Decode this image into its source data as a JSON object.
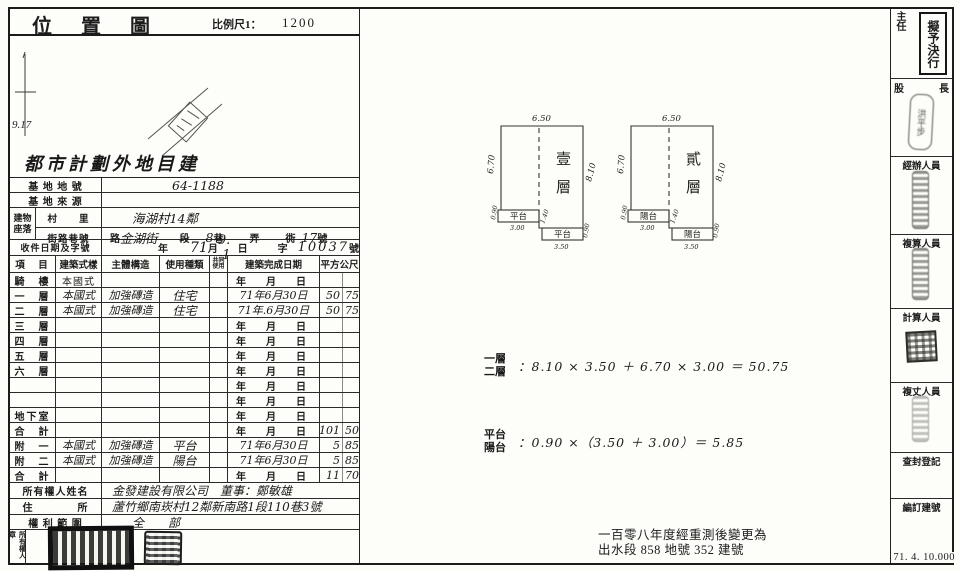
{
  "map": {
    "title": "位 置 圖",
    "scale_label": "比例尺1：",
    "scale_value": "1200",
    "north_value": "9.17",
    "overlay": "都市計劃外地目建"
  },
  "site": {
    "lot_label": "基 地 地 號",
    "lot_value": "64-1188",
    "source_label": "基 地 來 源",
    "source_value": "",
    "bldg_label_top": "建物",
    "bldg_label_bottom": "座落",
    "village_label": "村　　里",
    "village_value": "海湖村14鄰",
    "street_label": "街路巷號",
    "street": {
      "road": "路",
      "road_value": "金湖街",
      "sec": "段",
      "lane_value": "8",
      "lane": "巷",
      "nong": "弄",
      "xiang": "衖",
      "no_value": "17",
      "no": "號"
    },
    "receipt_label": "收件日期及字號",
    "receipt": {
      "year": "年",
      "year_value": "71",
      "month": "月",
      "day_value": "9. -1",
      "day": "日",
      "zi": "字",
      "no_value": "10037",
      "hao": "號"
    }
  },
  "floors": {
    "header": {
      "item": "項　目",
      "style": "建築式樣",
      "structure": "主體構造",
      "use": "使用種類",
      "tiny_top": "共同",
      "tiny_bottom": "使用",
      "date": "建築完成日期",
      "area": "平方公尺"
    },
    "rows": [
      {
        "name": "騎　樓",
        "style": "本國式",
        "style_class": "printedv",
        "structure": "",
        "use": "",
        "date": "年　月　日",
        "date_class": "pdate",
        "area_int": "",
        "area_dec": ""
      },
      {
        "name": "一　層",
        "style": "本國式",
        "style_class": "hand",
        "structure": "加強磚造",
        "use": "住宅",
        "date": "71年6月30日",
        "date_class": "hand",
        "area_int": "50",
        "area_dec": "75"
      },
      {
        "name": "二　層",
        "style": "本國式",
        "style_class": "hand",
        "structure": "加強磚造",
        "use": "住宅",
        "date": "71年.6月30日",
        "date_class": "hand",
        "area_int": "50",
        "area_dec": "75"
      },
      {
        "name": "三　層",
        "style": "",
        "style_class": "",
        "structure": "",
        "use": "",
        "date": "年　月　日",
        "date_class": "pdate",
        "area_int": "",
        "area_dec": ""
      },
      {
        "name": "四　層",
        "style": "",
        "style_class": "",
        "structure": "",
        "use": "",
        "date": "年　月　日",
        "date_class": "pdate",
        "area_int": "",
        "area_dec": ""
      },
      {
        "name": "五　層",
        "style": "",
        "style_class": "",
        "structure": "",
        "use": "",
        "date": "年　月　日",
        "date_class": "pdate",
        "area_int": "",
        "area_dec": ""
      },
      {
        "name": "六　層",
        "style": "",
        "style_class": "",
        "structure": "",
        "use": "",
        "date": "年　月　日",
        "date_class": "pdate",
        "area_int": "",
        "area_dec": ""
      },
      {
        "name": "",
        "style": "",
        "style_class": "",
        "structure": "",
        "use": "",
        "date": "年　月　日",
        "date_class": "pdate",
        "area_int": "",
        "area_dec": ""
      },
      {
        "name": "",
        "style": "",
        "style_class": "",
        "structure": "",
        "use": "",
        "date": "年　月　日",
        "date_class": "pdate",
        "area_int": "",
        "area_dec": ""
      },
      {
        "name": "地下室",
        "style": "",
        "style_class": "",
        "structure": "",
        "use": "",
        "date": "年　月　日",
        "date_class": "pdate",
        "area_int": "",
        "area_dec": ""
      },
      {
        "name": "合　計",
        "style": "",
        "style_class": "",
        "structure": "",
        "use": "",
        "date": "年　月　日",
        "date_class": "pdate",
        "area_int": "101",
        "area_dec": "50"
      },
      {
        "name": "附　一",
        "style": "本國式",
        "style_class": "hand",
        "structure": "加強磚造",
        "use": "平台",
        "date": "71年6月30日",
        "date_class": "hand",
        "area_int": "5",
        "area_dec": "85"
      },
      {
        "name": "附　二",
        "style": "本國式",
        "style_class": "hand",
        "structure": "加強磚造",
        "use": "陽台",
        "date": "71年6月30日",
        "date_class": "hand",
        "area_int": "5",
        "area_dec": "85"
      },
      {
        "name": "合　計",
        "style": "",
        "style_class": "",
        "structure": "",
        "use": "",
        "date": "年　月　日",
        "date_class": "pdate",
        "area_int": "11",
        "area_dec": "70"
      }
    ]
  },
  "owner": {
    "name_label": "所有權人姓名",
    "name_value": "金發建設有限公司　董事：鄭敏雄",
    "addr_label": "住　　　　所",
    "addr_value": "蘆竹鄉南崁村12鄰新南路1段110巷3號",
    "scope_label": "權 利 範 圍",
    "scope_value": "全　　部",
    "seal_label": "所有權人章"
  },
  "plans": {
    "p1": {
      "title_1": "壹",
      "title_2": "層",
      "top": "6.50",
      "left": "6.70",
      "right": "8.10",
      "annex1": "平台",
      "annex1_w": "3.00",
      "annex1_d": "0.90",
      "step": "1.40",
      "annex2": "平台",
      "annex2_w": "3.50",
      "annex2_d": "0.90"
    },
    "p2": {
      "title_1": "貳",
      "title_2": "層",
      "top": "6.50",
      "left": "6.70",
      "right": "8.10",
      "annex1": "陽台",
      "annex1_w": "3.00",
      "annex1_d": "0.90",
      "step": "1.40",
      "annex2": "陽台",
      "annex2_w": "3.50",
      "annex2_d": "0.90"
    }
  },
  "calc": {
    "c1_l1": "一層",
    "c1_l2": "二層",
    "c1_expr": "：8.10 × 3.50 ＋ 6.70 × 3.00 ＝ 50.75",
    "c2_l1": "平台",
    "c2_l2": "陽台",
    "c2_expr": "：0.90 ×（3.50 ＋ 3.00）＝ 5.85"
  },
  "strip": {
    "cells": [
      {
        "label": "主任"
      },
      {
        "label": "股長"
      },
      {
        "label": "經辦人員"
      },
      {
        "label": "複算人員"
      },
      {
        "label": "計算人員"
      },
      {
        "label": "複丈人員"
      },
      {
        "label": "查封登記"
      },
      {
        "label": "編訂建號"
      }
    ],
    "cell2_left": "股",
    "cell2_right": "長",
    "approval_stamp": "擬予決行",
    "chief_seal_name": "洪平步",
    "form_code": "71. 4. 10.000"
  },
  "note": {
    "line1": "一百零八年度經重測後變更為",
    "line2": "出水段 858 地號 352 建號"
  }
}
